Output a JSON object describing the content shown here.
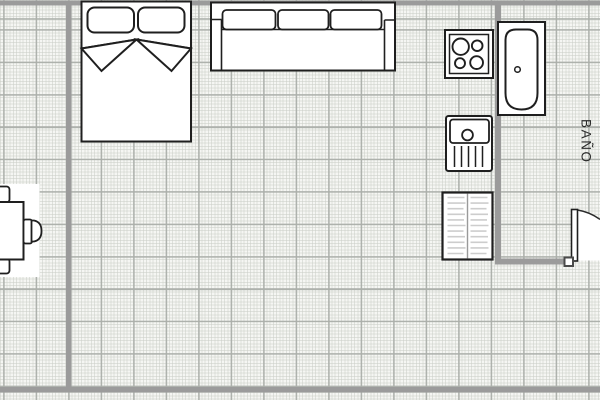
{
  "rooms": {
    "bathroom": "BAÑO"
  },
  "furniture": {
    "bed": "double-bed-with-pillows",
    "sofa": "three-seat-sofa",
    "stove": "cooktop-four-burners",
    "bathtub": "bathtub",
    "sink": "sink-with-drainboard",
    "wardrobe": "shelved-cabinet",
    "table": "table-with-chairs",
    "door": "door-with-swing-arc"
  },
  "colors": {
    "paper": "#f5f6f3",
    "grid_major": "#abafaa",
    "grid_fine": "#d9dbd6",
    "wall": "#9b9b9b",
    "outline": "#1f1f1f",
    "shelf_lines": "#cdcdcd",
    "label_text": "#2b2b2b"
  }
}
